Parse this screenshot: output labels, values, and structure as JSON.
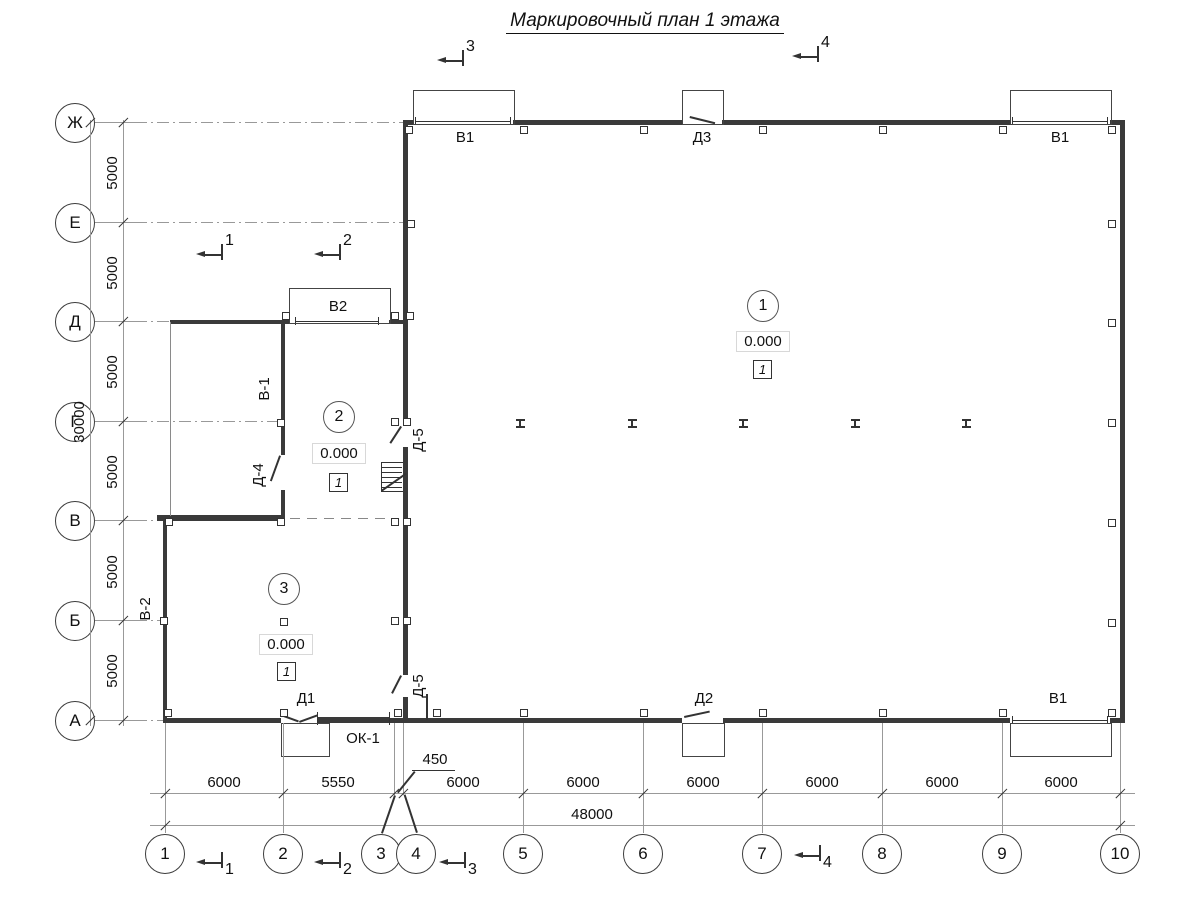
{
  "title": "Маркировочный план 1 этажа",
  "colors": {
    "wall": "#3a3a3a",
    "thin_line": "#8a8a8a",
    "axis_line": "#999999",
    "text": "#111111",
    "background": "#ffffff"
  },
  "axes": {
    "rows": [
      {
        "label": "Ж"
      },
      {
        "label": "Е"
      },
      {
        "label": "Д"
      },
      {
        "label": "Г"
      },
      {
        "label": "В"
      },
      {
        "label": "Б"
      },
      {
        "label": "А"
      }
    ],
    "cols": [
      {
        "label": "1"
      },
      {
        "label": "2"
      },
      {
        "label": "3"
      },
      {
        "label": "4"
      },
      {
        "label": "5"
      },
      {
        "label": "6"
      },
      {
        "label": "7"
      },
      {
        "label": "8"
      },
      {
        "label": "9"
      },
      {
        "label": "10"
      }
    ]
  },
  "dimensions": {
    "row_spacings": [
      "5000",
      "5000",
      "5000",
      "5000",
      "5000",
      "5000"
    ],
    "row_total": "30000",
    "col_spacings": [
      "6000",
      "5550",
      "450",
      "6000",
      "6000",
      "6000",
      "6000",
      "6000",
      "6000"
    ],
    "col_total": "48000"
  },
  "sections": {
    "top_3": "3",
    "top_4": "4",
    "mid_1": "1",
    "mid_2": "2",
    "bot_1": "1",
    "bot_2": "2",
    "bot_3": "3",
    "bot_4": "4"
  },
  "rooms": [
    {
      "number": "1",
      "elevation": "0.000",
      "floor_type": "1"
    },
    {
      "number": "2",
      "elevation": "0.000",
      "floor_type": "1"
    },
    {
      "number": "3",
      "elevation": "0.000",
      "floor_type": "1"
    }
  ],
  "labels": {
    "v1_top_left": "В1",
    "d3_top": "Д3",
    "v1_top_right": "В1",
    "v2": "В2",
    "v_1": "В-1",
    "d_4": "Д-4",
    "d_5_upper": "Д-5",
    "d_5_lower": "Д-5",
    "v_2": "В-2",
    "d1": "Д1",
    "ok1": "ОК-1",
    "d2": "Д2",
    "v1_bottom_right": "В1"
  }
}
